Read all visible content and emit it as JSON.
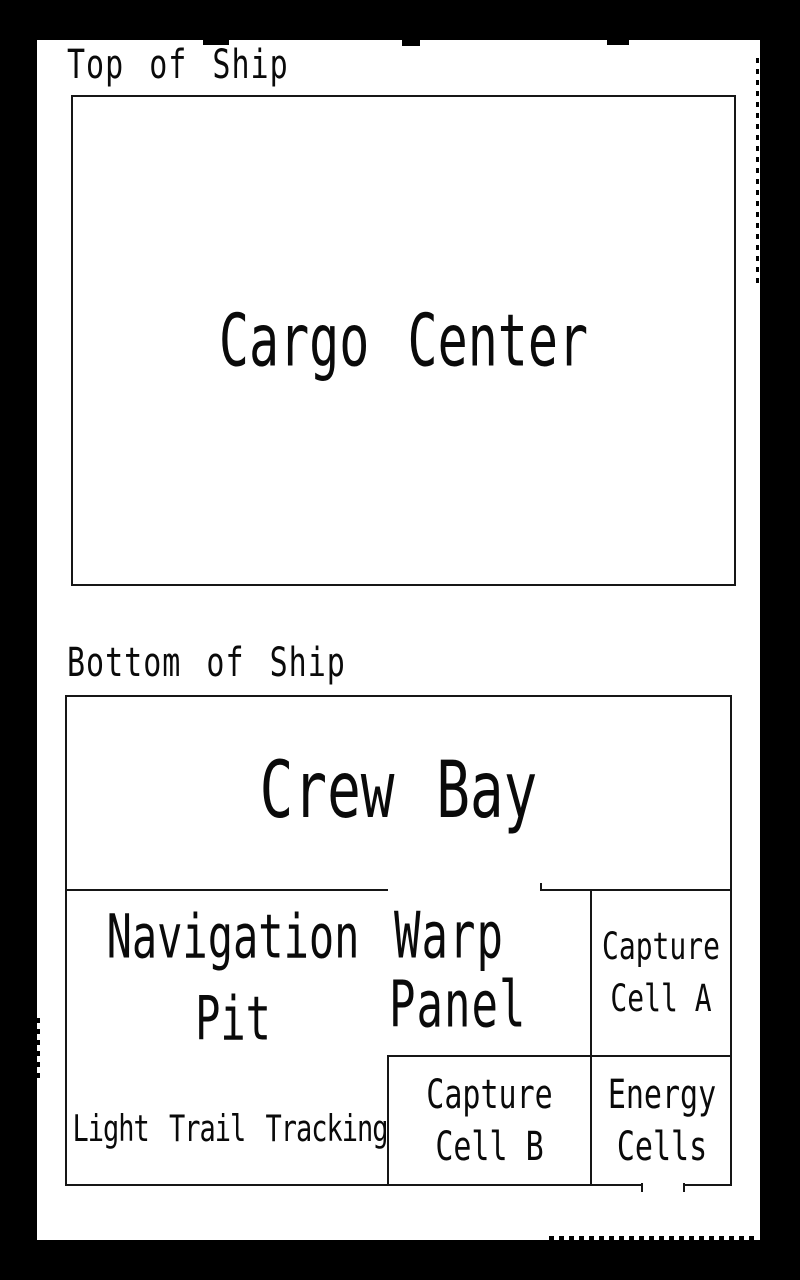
{
  "colors": {
    "background": "#000000",
    "paper": "#ffffff",
    "ink": "#161616"
  },
  "deck_labels": {
    "top": "Top of Ship",
    "bottom": "Bottom of Ship"
  },
  "rooms": {
    "cargo_center": "Cargo Center",
    "crew_bay": "Crew Bay",
    "navigation_pit": {
      "line1": "Navigation",
      "line2": "Pit"
    },
    "warp_panel": {
      "line1": "Warp",
      "line2": "Panel"
    },
    "capture_cell_a": {
      "line1": "Capture",
      "line2": "Cell A"
    },
    "light_trail_tracking": "Light Trail Tracking",
    "capture_cell_b": {
      "line1": "Capture",
      "line2": "Cell B"
    },
    "energy_cells": {
      "line1": "Energy",
      "line2": "Cells"
    }
  }
}
